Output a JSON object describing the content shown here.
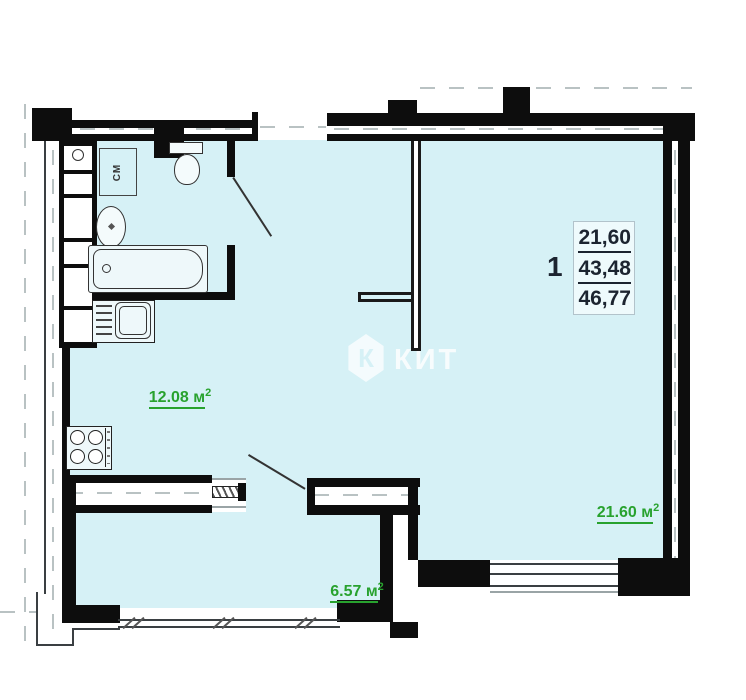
{
  "plan": {
    "watermark": {
      "logo_letter": "К",
      "text": "КИТ"
    },
    "unit_stats": {
      "number": "1",
      "area_top": "21,60",
      "area_mid": "43,48",
      "area_bottom": "46,77"
    },
    "labels": {
      "kitchen": {
        "value": "12.08",
        "unit": "м",
        "sup": "2"
      },
      "living": {
        "value": "21.60",
        "unit": "м",
        "sup": "2"
      },
      "balcony": {
        "value": "6.57",
        "unit": "м",
        "sup": "2"
      }
    },
    "fixtures": {
      "washing_machine": "СМ"
    },
    "colors": {
      "room_fill": "#d6f1f6",
      "wall": "#0d0d0d",
      "area_label_green": "#28a22e",
      "stats_text": "#1c2430"
    }
  }
}
